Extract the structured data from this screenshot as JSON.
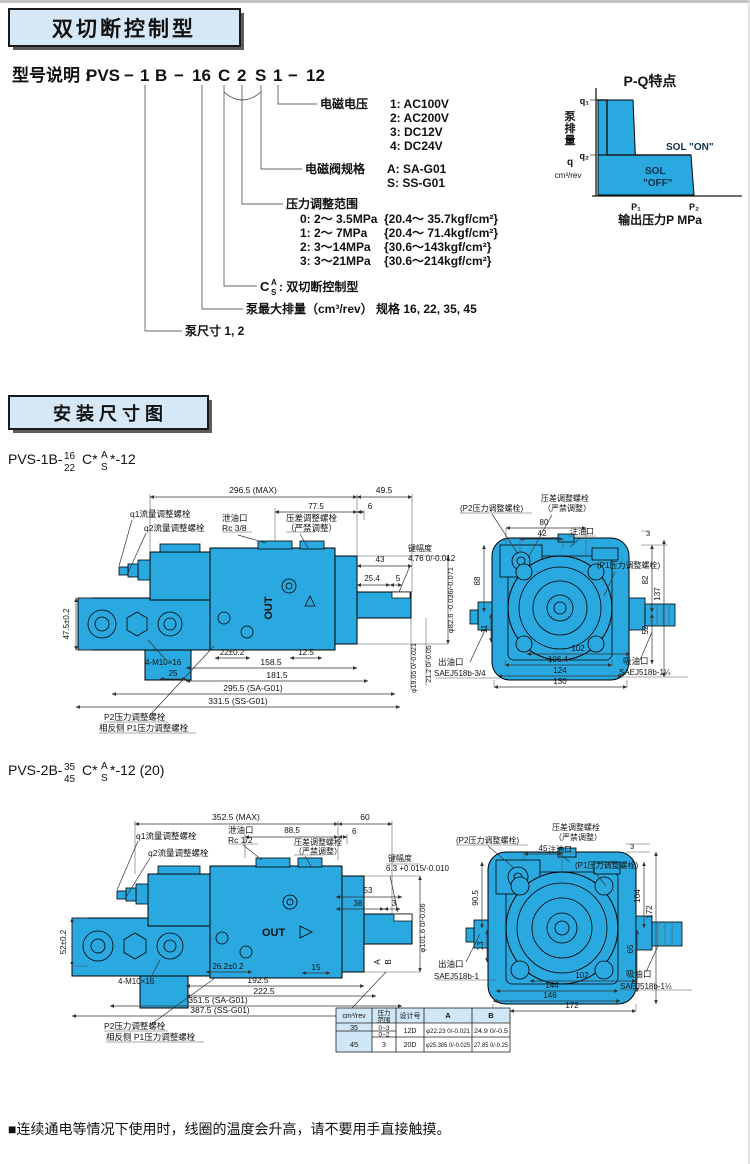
{
  "headers": {
    "h1": "双切断控制型",
    "h2": "安 装 尺 寸 图"
  },
  "colors": {
    "pump_fill": "#29A9E0",
    "header_fill": "#D6E8F6",
    "sol_text": "#0D3050"
  },
  "model": {
    "prefix": "型号说明 :",
    "seg": [
      "PVS",
      "−",
      "1",
      "B",
      "−",
      "16",
      "C",
      "2",
      "S",
      "1",
      "−",
      "12"
    ],
    "voltage_label": "电磁电压",
    "voltage_options": [
      "1:  AC100V",
      "2:  AC200V",
      "3:  DC12V",
      "4:  DC24V"
    ],
    "valve_label": "电磁阀规格",
    "valve_options": [
      "A:  SA-G01",
      "S:  SS-G01"
    ],
    "pressure_label": "压力调整范围",
    "pressure_options": [
      "0:  2～ 3.5MPa",
      "1:  2～ 7MPa",
      "2:  3～14MPa",
      "3:  3～21MPa"
    ],
    "pressure_kgf": [
      "{20.4～ 35.7kgf/cm²}",
      "{20.4～ 71.4kgf/cm²}",
      "{30.6～143kgf/cm²}",
      "{30.6～214kgf/cm²}"
    ],
    "control_c": "C",
    "control_a": "A",
    "control_s": "S",
    "control_text": ":  双切断控制型",
    "displacement": "泵最大排量（cm³/rev）  规格 16, 22, 35, 45",
    "pump_size": "泵尺寸  1, 2"
  },
  "pq": {
    "title": "P-Q特点",
    "ylabel": "泵排量",
    "y_q": "q",
    "y_unit": "cm³/rev",
    "q1": "q₁",
    "q2": "q₂",
    "p1": "P₁",
    "p2": "P₂",
    "sol_on": "SOL \"ON\"",
    "sol_off_1": "SOL",
    "sol_off_2": "\"OFF\"",
    "xlabel": "输出压力P MPa"
  },
  "sub1": {
    "prefix": "PVS-1B-",
    "num": "16",
    "den": "22",
    "c": "C*",
    "a": "A",
    "s": "S",
    "suffix": "*-12"
  },
  "sub2": {
    "prefix": "PVS-2B-",
    "num": "35",
    "den": "45",
    "c": "C*",
    "a": "A",
    "s": "S",
    "suffix": "*-12 (20)"
  },
  "d1s": {
    "max": "296.5 (MAX)",
    "d495": "49.5",
    "d775": "77.5",
    "d6": "6",
    "d43": "43",
    "key_label": "键幅度",
    "key_val": "4.76 0/-0.012",
    "d254": "25.4",
    "d5": "5",
    "dia826": "φ82.6 -0.036/-0.071",
    "dia1905": "φ19.05 0/-0.021",
    "d212": "21.2 0/-0.05",
    "d475": "47.5±0.2",
    "bolts": "4-M10×16",
    "d22": "22±0.2",
    "d125": "12.5",
    "d25": "25",
    "d1585": "158.5",
    "d1815": "181.5",
    "sa": "295.5 (SA-G01)",
    "ss": "331.5 (SS-G01)",
    "q1": "q1流量调整螺栓",
    "q2": "q2流量调整螺栓",
    "drain1": "泄油口",
    "drain2": "Rc 3/8",
    "comp1": "压差调整螺栓",
    "comp2": "（严禁调整）",
    "p2": "P2压力调整螺栓",
    "p1": "相反侧 P1压力调整螺栓",
    "out": "OUT"
  },
  "d1r": {
    "p2": "(P2压力调整螺栓)",
    "comp1": "压差调整螺栓",
    "comp2": "（严禁调整）",
    "fill": "注油口",
    "p1": "(P1压力调整螺栓)",
    "d80": "80",
    "d42": "42",
    "d3": "3",
    "d88": "88",
    "d11": "11",
    "d82": "82",
    "d137": "137",
    "d52": "52",
    "d102": "102",
    "d1064": "106.4",
    "d124": "124",
    "d130": "130",
    "outlet1": "出油口",
    "outlet2": "SAEJ518b-3/4",
    "inlet1": "吸油口",
    "inlet2": "SAEJ518b-1¼"
  },
  "d2s": {
    "max": "352.5 (MAX)",
    "d60": "60",
    "d885": "88.5",
    "d6": "6",
    "drain1": "泄油口",
    "drain2": "Rc 1/2",
    "comp1": "压差调整螺栓",
    "comp2": "（严禁调整）",
    "q1": "q1流量调整螺栓",
    "q2": "q2流量调整螺栓",
    "key_label": "键幅度",
    "key_val": "6.3 +0.015/-0.010",
    "d53": "53",
    "d38": "38",
    "d3": "3",
    "dia1016": "φ101.6 0/-0.06",
    "d52": "52±0.2",
    "bolts": "4-M10×16",
    "d262": "26.2±0.2",
    "d15": "15",
    "d1925": "192.5",
    "d2225": "222.5",
    "sa": "351.5 (SA-G01)",
    "ss": "387.5 (SS-G01)",
    "p2": "P2压力调整螺栓",
    "p1": "相反侧 P1压力调整螺栓",
    "a": "A",
    "b": "B",
    "out": "OUT"
  },
  "d2r": {
    "p2": "(P2压力调整螺栓)",
    "d45": "45",
    "comp1": "压差调整螺栓",
    "comp2": "（严禁调整）",
    "fill": "注油口",
    "p1": "(P1压力调整螺栓)",
    "d3": "3",
    "d905": "90.5",
    "d13": "13",
    "d104": "104",
    "d172": "172",
    "d65": "65",
    "d102": "102",
    "d144": "144",
    "d146": "146",
    "d172b": "172",
    "outlet1": "出油口",
    "outlet2": "SAEJ518b-1",
    "inlet1": "吸油口",
    "inlet2": "SAEJ518b-1¼"
  },
  "table": {
    "h0": "cm³/rev",
    "h1a": "压力",
    "h1b": "范围",
    "h2": "设计号",
    "h3": "A",
    "h4": "B",
    "r35": "35",
    "r45": "45",
    "p03": "0~3",
    "p02": "0~2",
    "p3": "3",
    "d12": "12D",
    "d20": "20D",
    "a12": "φ22.23 0/-0.021",
    "b12": "24.9 0/-0.5",
    "a20": "φ25.385 0/-0.025",
    "b20": "27.85 0/-0.25"
  },
  "footer": "■连续通电等情况下使用时，线圈的温度会升高，请不要用手直接触摸。"
}
